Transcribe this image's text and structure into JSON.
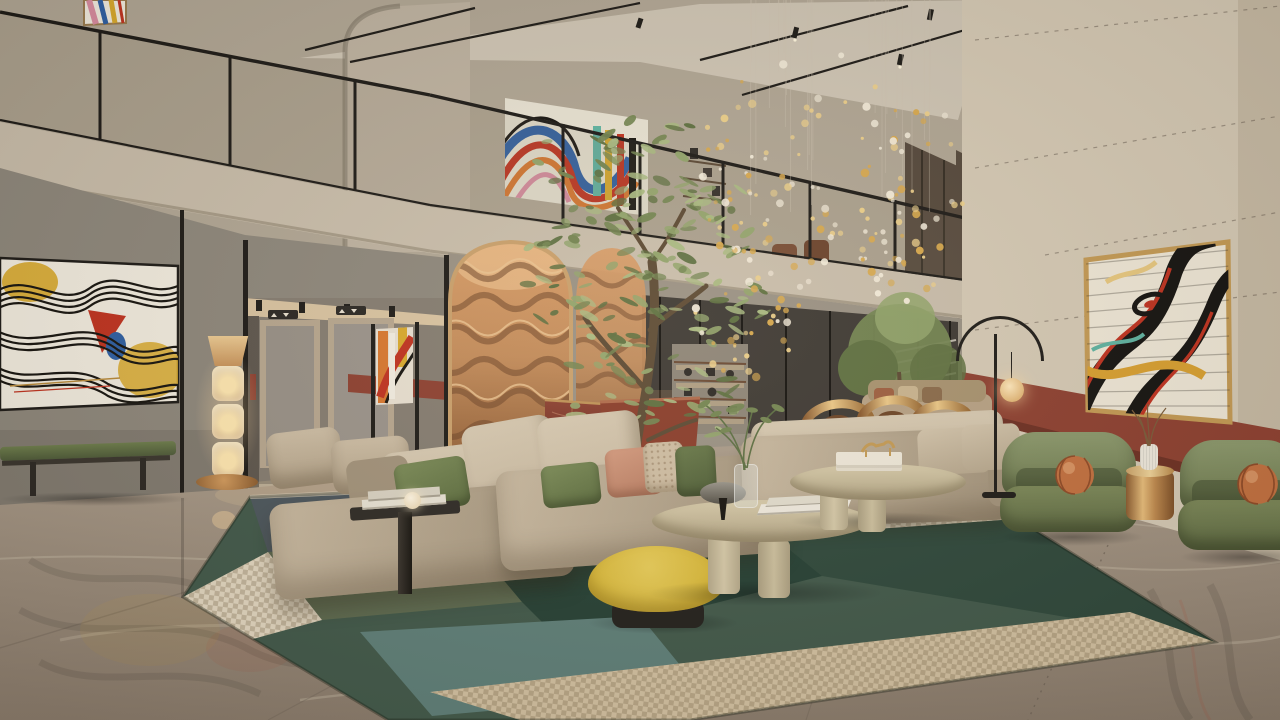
{
  "scene": {
    "label": "hotel-lobby-interior-rendering",
    "description": "Double-height hotel lobby atrium with mezzanine, abstract wall art, copper wave arch, beige sectional sofa, olive tree and gold leaf chandelier"
  },
  "palette": {
    "ceiling": "#cfc5b4",
    "mezzWall": "#b1a694",
    "mezzWall2": "#beb2a0",
    "fascia": "#c9bdaa",
    "fasciaEdge": "#a79b87",
    "leftWall": "#8e877b",
    "leftWallDk": "#6e675d",
    "backWall": "#9a9183",
    "corridor": "#857c70",
    "corridorDk": "#5e564d",
    "corridorGlow": "#d9c3a0",
    "rightWall": "#d5c9b4",
    "rightWallDk": "#bdb09a",
    "terracotta": "#8e4030",
    "terracottaDk": "#6e3023",
    "copper": "#c38b59",
    "copperHi": "#ecc491",
    "copperDk": "#6f4528",
    "glass": "#3e3933",
    "bronzeGlass": "#55483b",
    "blind": "#e8e0d2",
    "floorHi": "#b2a391",
    "floorMid": "#9e8f7e",
    "floorDk": "#87786a",
    "vein": "#dccfbb",
    "seam": "#6d6154",
    "rugGreen": "#42594a",
    "rugGreen2": "#2f483b",
    "rugEmerald": "#264034",
    "rugMoss": "#5f6c51",
    "rugTeal": "#5f7f78",
    "rugSlate": "#4c565c",
    "rugBeige": "#d3c1a1",
    "rugCream": "#e3d7c0",
    "sofa": "#c9b9a0",
    "sofaHi": "#d7c9b1",
    "sofaDk": "#a2927a",
    "cushion": "#d2c3aa",
    "pillowGreen": "#6d7d4b",
    "pillowGreen2": "#5d6d40",
    "pillowSalmon": "#c98f73",
    "pillowPatt": "#cfbda2",
    "pouf": "#d9b838",
    "poufHi": "#e8cc58",
    "poufDk": "#23201c",
    "chairGreen": "#6e7a4f",
    "chairGreenHi": "#8d9a6d",
    "chairGreenDk": "#53603a",
    "pillowOrange": "#c3703f",
    "gold": "#c09256",
    "goldHi": "#ecc887",
    "goldDk": "#8a5a2e",
    "black": "#1e1b17",
    "canvas": "#f2ecdf",
    "artYellow": "#d9a92c",
    "artRed": "#c0321f",
    "artBlue": "#2e5fa3",
    "artOrange": "#d8772e",
    "artPink": "#d98ca0",
    "artTeal": "#5fb3a1",
    "artDark": "#17140f",
    "deskRed": "#7e3628",
    "deskRedHi": "#a3543e",
    "treeA": "#93a46b",
    "treeB": "#748551",
    "treeC": "#aab981",
    "treeD": "#5f7040",
    "trunk": "#5d4a33",
    "lampGlow": "#ffd9a0",
    "lampShade": "#e3b87e",
    "glassLamp": "#eedcba",
    "goldLeaf": "#d9a94e",
    "goldLeafHi": "#edcf8a",
    "leafWhite": "#f3ead8",
    "wire": "#cfc4b2",
    "bgSofa": "#b7a184",
    "rust": "#9e5f3f",
    "woodChair": "#7a4a30"
  },
  "rug": {
    "patches": [
      {
        "points": "250,497 448,488 470,540 268,552",
        "color": "rugSlate",
        "check": false
      },
      {
        "points": "268,552 470,540 522,602 322,620",
        "color": "rugMoss",
        "check": false
      },
      {
        "points": "736,506 935,468 1215,642 822,576",
        "color": "rugGreen2",
        "check": false
      },
      {
        "points": "448,488 700,478 736,506 470,540",
        "color": "rugBeige",
        "check": true
      },
      {
        "points": "470,540 736,506 822,576 562,642 522,602",
        "color": "rugEmerald",
        "check": false
      },
      {
        "points": "360,632 640,616 702,692 432,716",
        "color": "rugTeal",
        "check": false
      },
      {
        "points": "820,492 1002,483 1044,517 862,530",
        "color": "rugCream",
        "check": true
      },
      {
        "points": "430,692 1130,612 1215,642 690,720 520,720",
        "color": "rugBeige",
        "check": true
      },
      {
        "points": "183,597 268,552 322,620 242,642",
        "color": "rugCream",
        "check": true
      }
    ]
  },
  "tree": {
    "count": 185,
    "colors": [
      "treeA",
      "treeB",
      "treeC",
      "treeD"
    ],
    "clumps": [
      {
        "cx": 650,
        "cy": 195,
        "rx": 100,
        "ry": 80,
        "w": 0.3
      },
      {
        "cx": 590,
        "cy": 290,
        "rx": 75,
        "ry": 80,
        "w": 0.2
      },
      {
        "cx": 705,
        "cy": 285,
        "rx": 65,
        "ry": 70,
        "w": 0.18
      },
      {
        "cx": 625,
        "cy": 385,
        "rx": 60,
        "ry": 55,
        "w": 0.14
      },
      {
        "cx": 700,
        "cy": 395,
        "rx": 45,
        "ry": 45,
        "w": 0.1
      },
      {
        "cx": 585,
        "cy": 168,
        "rx": 55,
        "ry": 45,
        "w": 0.08
      }
    ]
  },
  "chandelier": {
    "count": 165,
    "wires": 28,
    "colors": [
      "goldLeaf",
      "goldLeafHi",
      "leafWhite"
    ],
    "clusters": [
      {
        "cx": 832,
        "cy": 168,
        "rx": 138,
        "ry": 118,
        "w": 0.62
      },
      {
        "cx": 748,
        "cy": 300,
        "rx": 55,
        "ry": 95,
        "w": 0.22
      },
      {
        "cx": 898,
        "cy": 255,
        "rx": 45,
        "ry": 62,
        "w": 0.16
      }
    ]
  }
}
